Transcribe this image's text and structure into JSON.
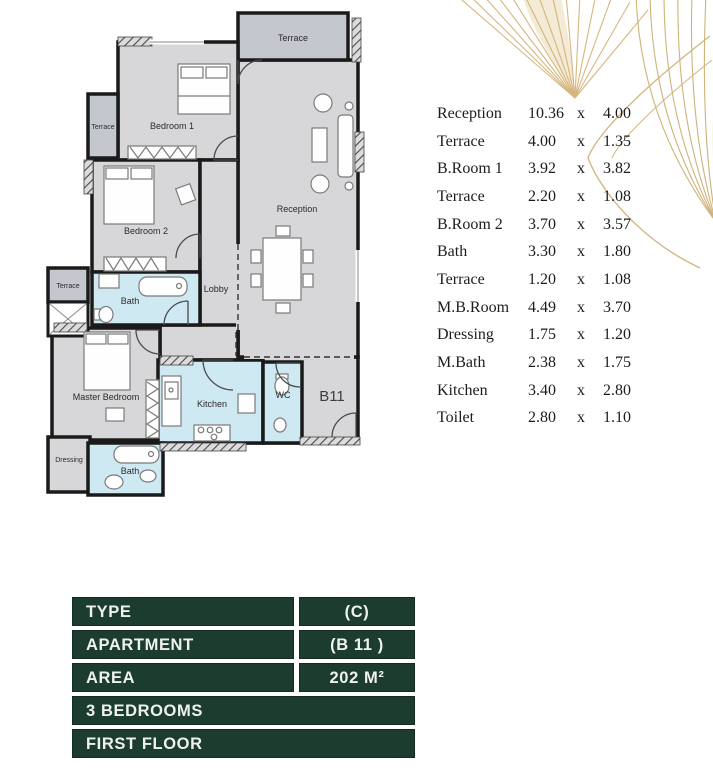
{
  "floor_plan": {
    "labels": {
      "terrace_top": "Terrace",
      "bedroom1": "Bedroom 1",
      "terrace_left": "Terrace",
      "bedroom2": "Bedroom 2",
      "reception": "Reception",
      "lobby": "Lobby",
      "bath_top": "Bath",
      "terrace_small": "Terrace",
      "master_bedroom": "Master Bedroom",
      "kitchen": "Kitchen",
      "wc": "WC",
      "dressing": "Dressing",
      "bath_bottom": "Bath",
      "unit": "B11"
    }
  },
  "dimensions": {
    "separator": "x",
    "rows": [
      {
        "room": "Reception",
        "w": "10.36",
        "h": "4.00"
      },
      {
        "room": "Terrace",
        "w": "4.00",
        "h": "1.35"
      },
      {
        "room": "B.Room 1",
        "w": "3.92",
        "h": "3.82"
      },
      {
        "room": "Terrace",
        "w": "2.20",
        "h": "1.08"
      },
      {
        "room": "B.Room 2",
        "w": "3.70",
        "h": "3.57"
      },
      {
        "room": "Bath",
        "w": "3.30",
        "h": "1.80"
      },
      {
        "room": "Terrace",
        "w": "1.20",
        "h": "1.08"
      },
      {
        "room": "M.B.Room",
        "w": "4.49",
        "h": "3.70"
      },
      {
        "room": "Dressing",
        "w": "1.75",
        "h": "1.20"
      },
      {
        "room": "M.Bath",
        "w": "2.38",
        "h": "1.75"
      },
      {
        "room": "Kitchen",
        "w": "3.40",
        "h": "2.80"
      },
      {
        "room": "Toilet",
        "w": "2.80",
        "h": "1.10"
      }
    ]
  },
  "info": {
    "type_label": "TYPE",
    "type_value": "(C)",
    "apartment_label": "APARTMENT",
    "apartment_value": "(B 11 )",
    "area_label": "AREA",
    "area_value": "202 M²",
    "bedrooms": "3 BEDROOMS",
    "floor": "FIRST FLOOR"
  },
  "colors": {
    "panel_green": "#1d3c30",
    "accent_gold": "#cfa95f",
    "room_gray": "#d7d7d9",
    "terrace_gray": "#c4c7ce",
    "wet_blue": "#cfe9f3",
    "wall_black": "#1a1a1a"
  }
}
